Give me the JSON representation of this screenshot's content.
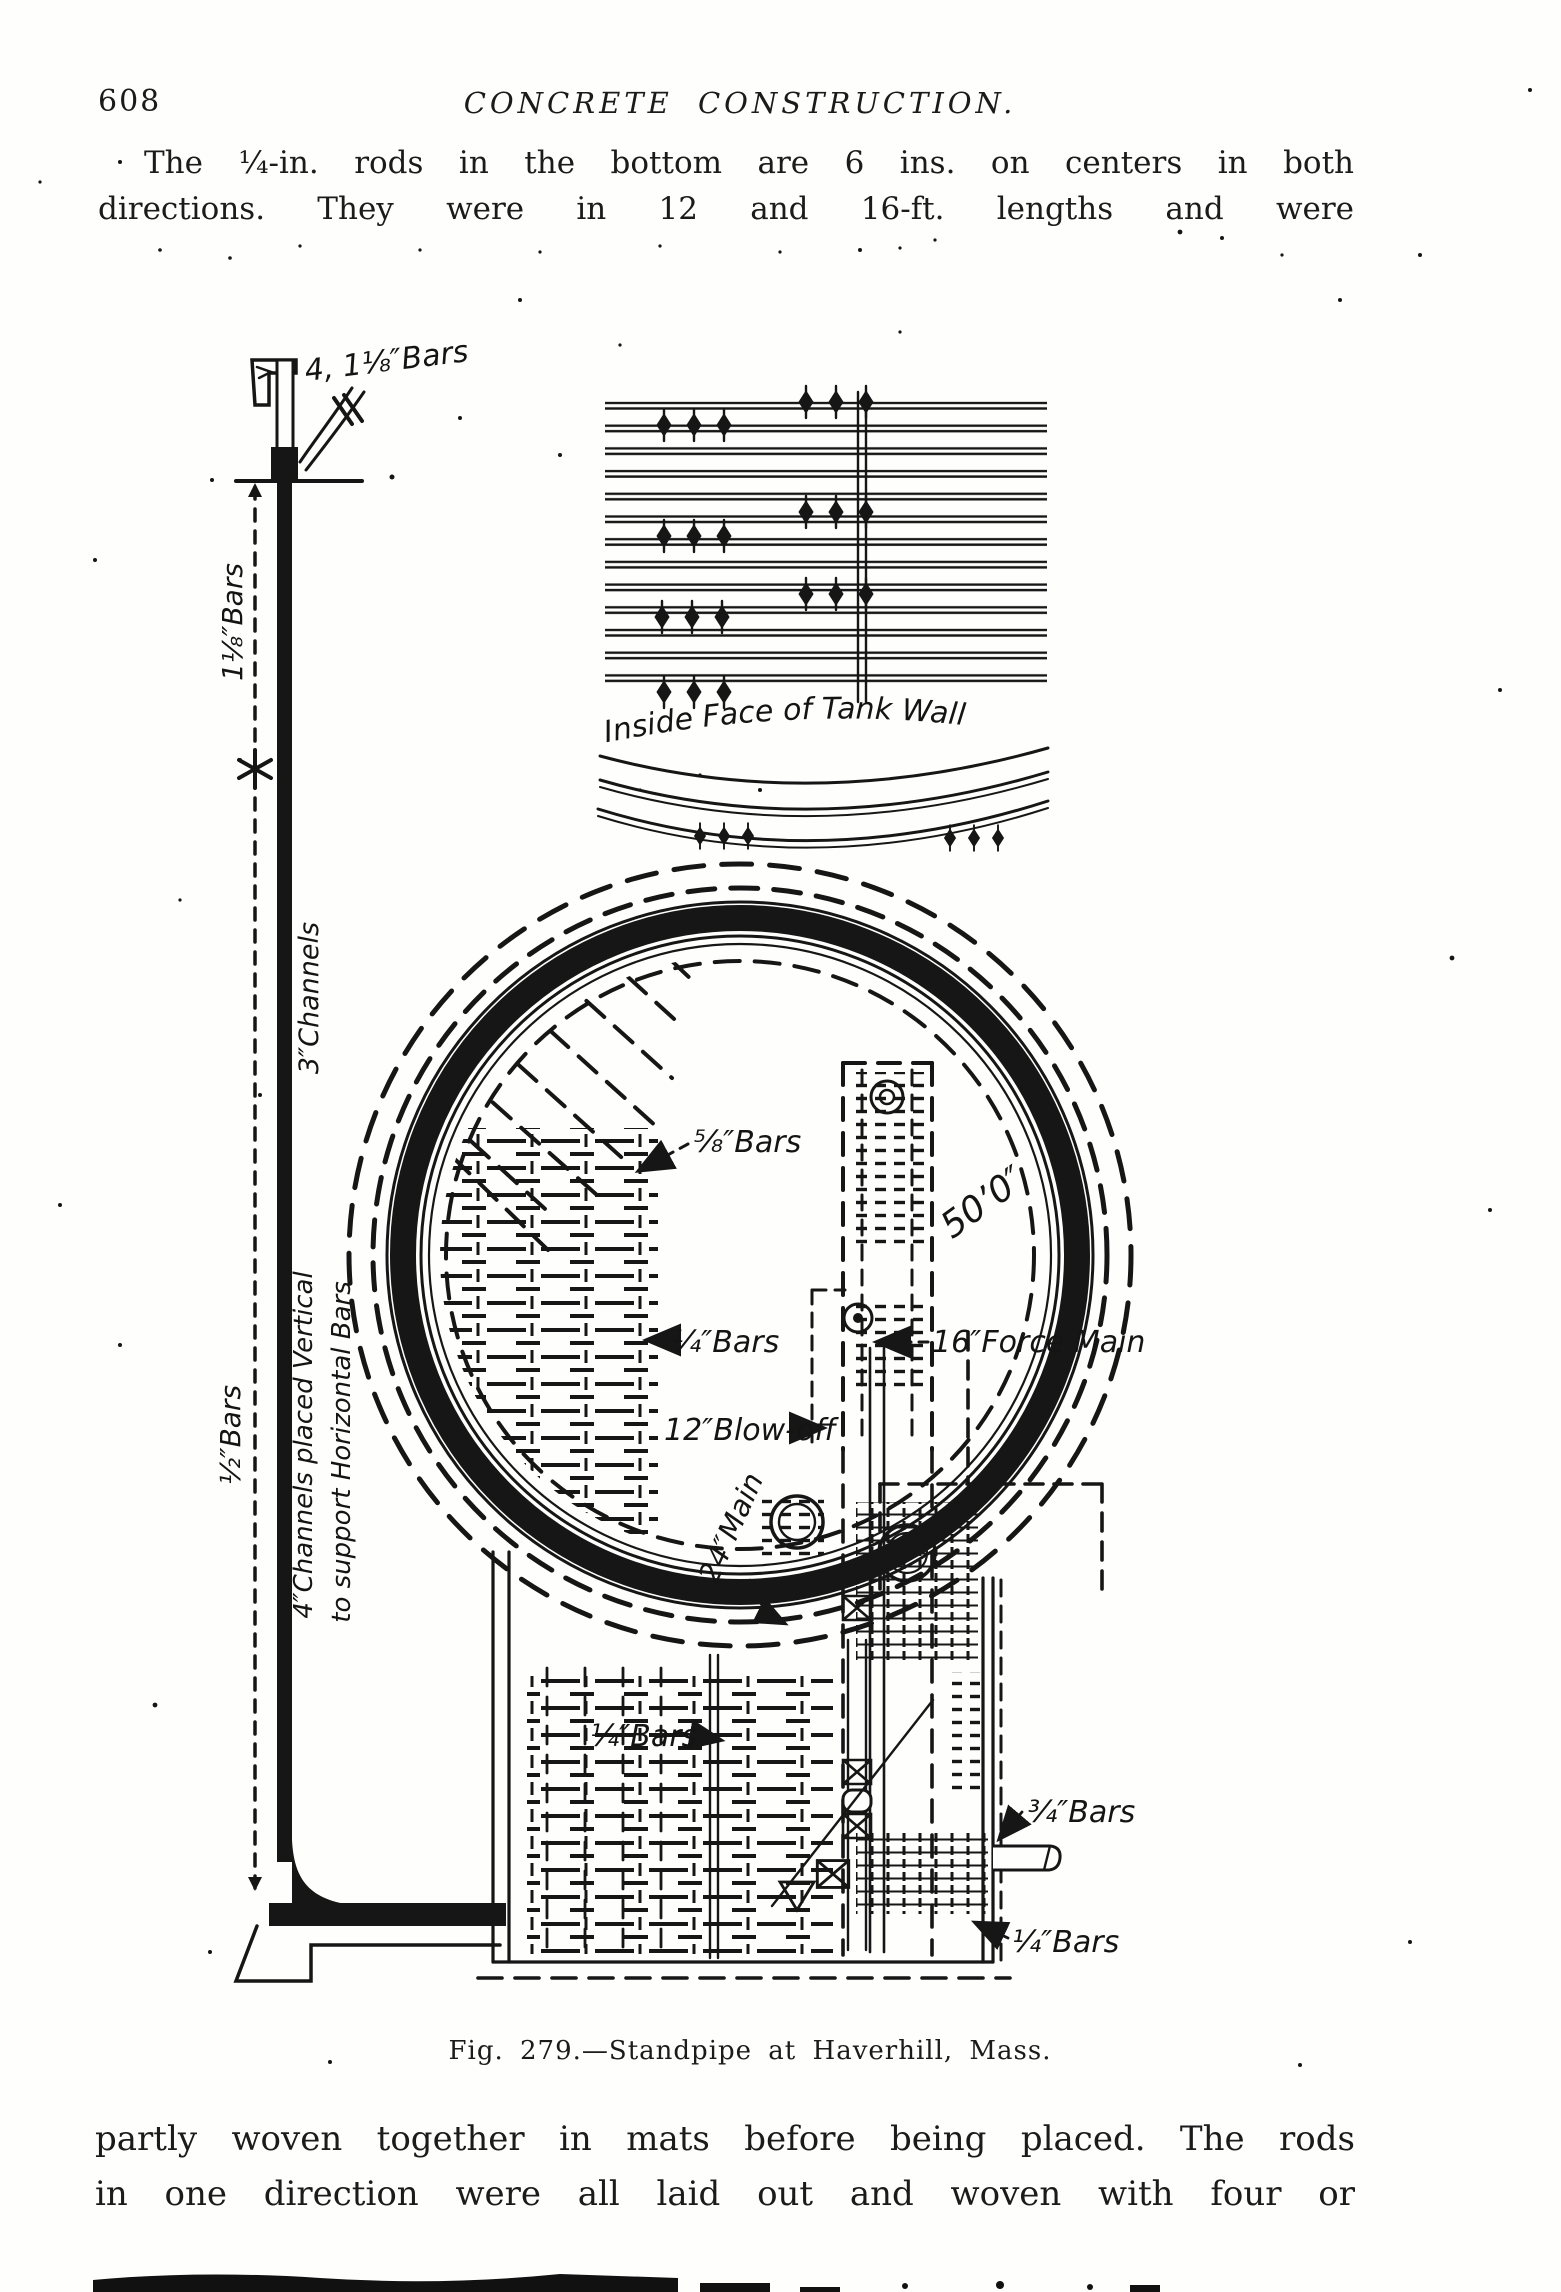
{
  "page": {
    "number": "608",
    "header": "CONCRETE CONSTRUCTION.",
    "paragraph_top": {
      "line1": "The ¼-in. rods in the bottom are 6 ins. on centers in both",
      "line2": "directions.  They were in 12 and 16-ft. lengths and were"
    },
    "caption": "Fig. 279.—Standpipe at Haverhill, Mass.",
    "paragraph_bottom": {
      "line1": "partly woven together in mats before being placed.  The rods",
      "line2": "in one direction were all laid out and woven with four or"
    }
  },
  "figure": {
    "ink_color": "#161616",
    "paper_color": "#fefefd",
    "labels": {
      "top_bars": "4, 1⅛″Bars",
      "dim_bars_upper": "1⅛″Bars",
      "channels_3": "3″Channels",
      "channels_4_line1": "4″Channels placed Vertical",
      "channels_4_line2": "to support Horizontal Bars",
      "dim_bars_lower": "½″Bars",
      "inside_face": "Inside Face of Tank Wall",
      "bars_58": "⅝″Bars",
      "diameter": "50’0″",
      "bars_14_mid": "¼″Bars",
      "force_main": "16″Force Main",
      "blow_off": "12″Blow-off",
      "main_24": "24″Main",
      "bars_14_pit": "¼″Bars",
      "bars_34": "¾″Bars",
      "bars_14_bottom": "¼″Bars"
    }
  }
}
